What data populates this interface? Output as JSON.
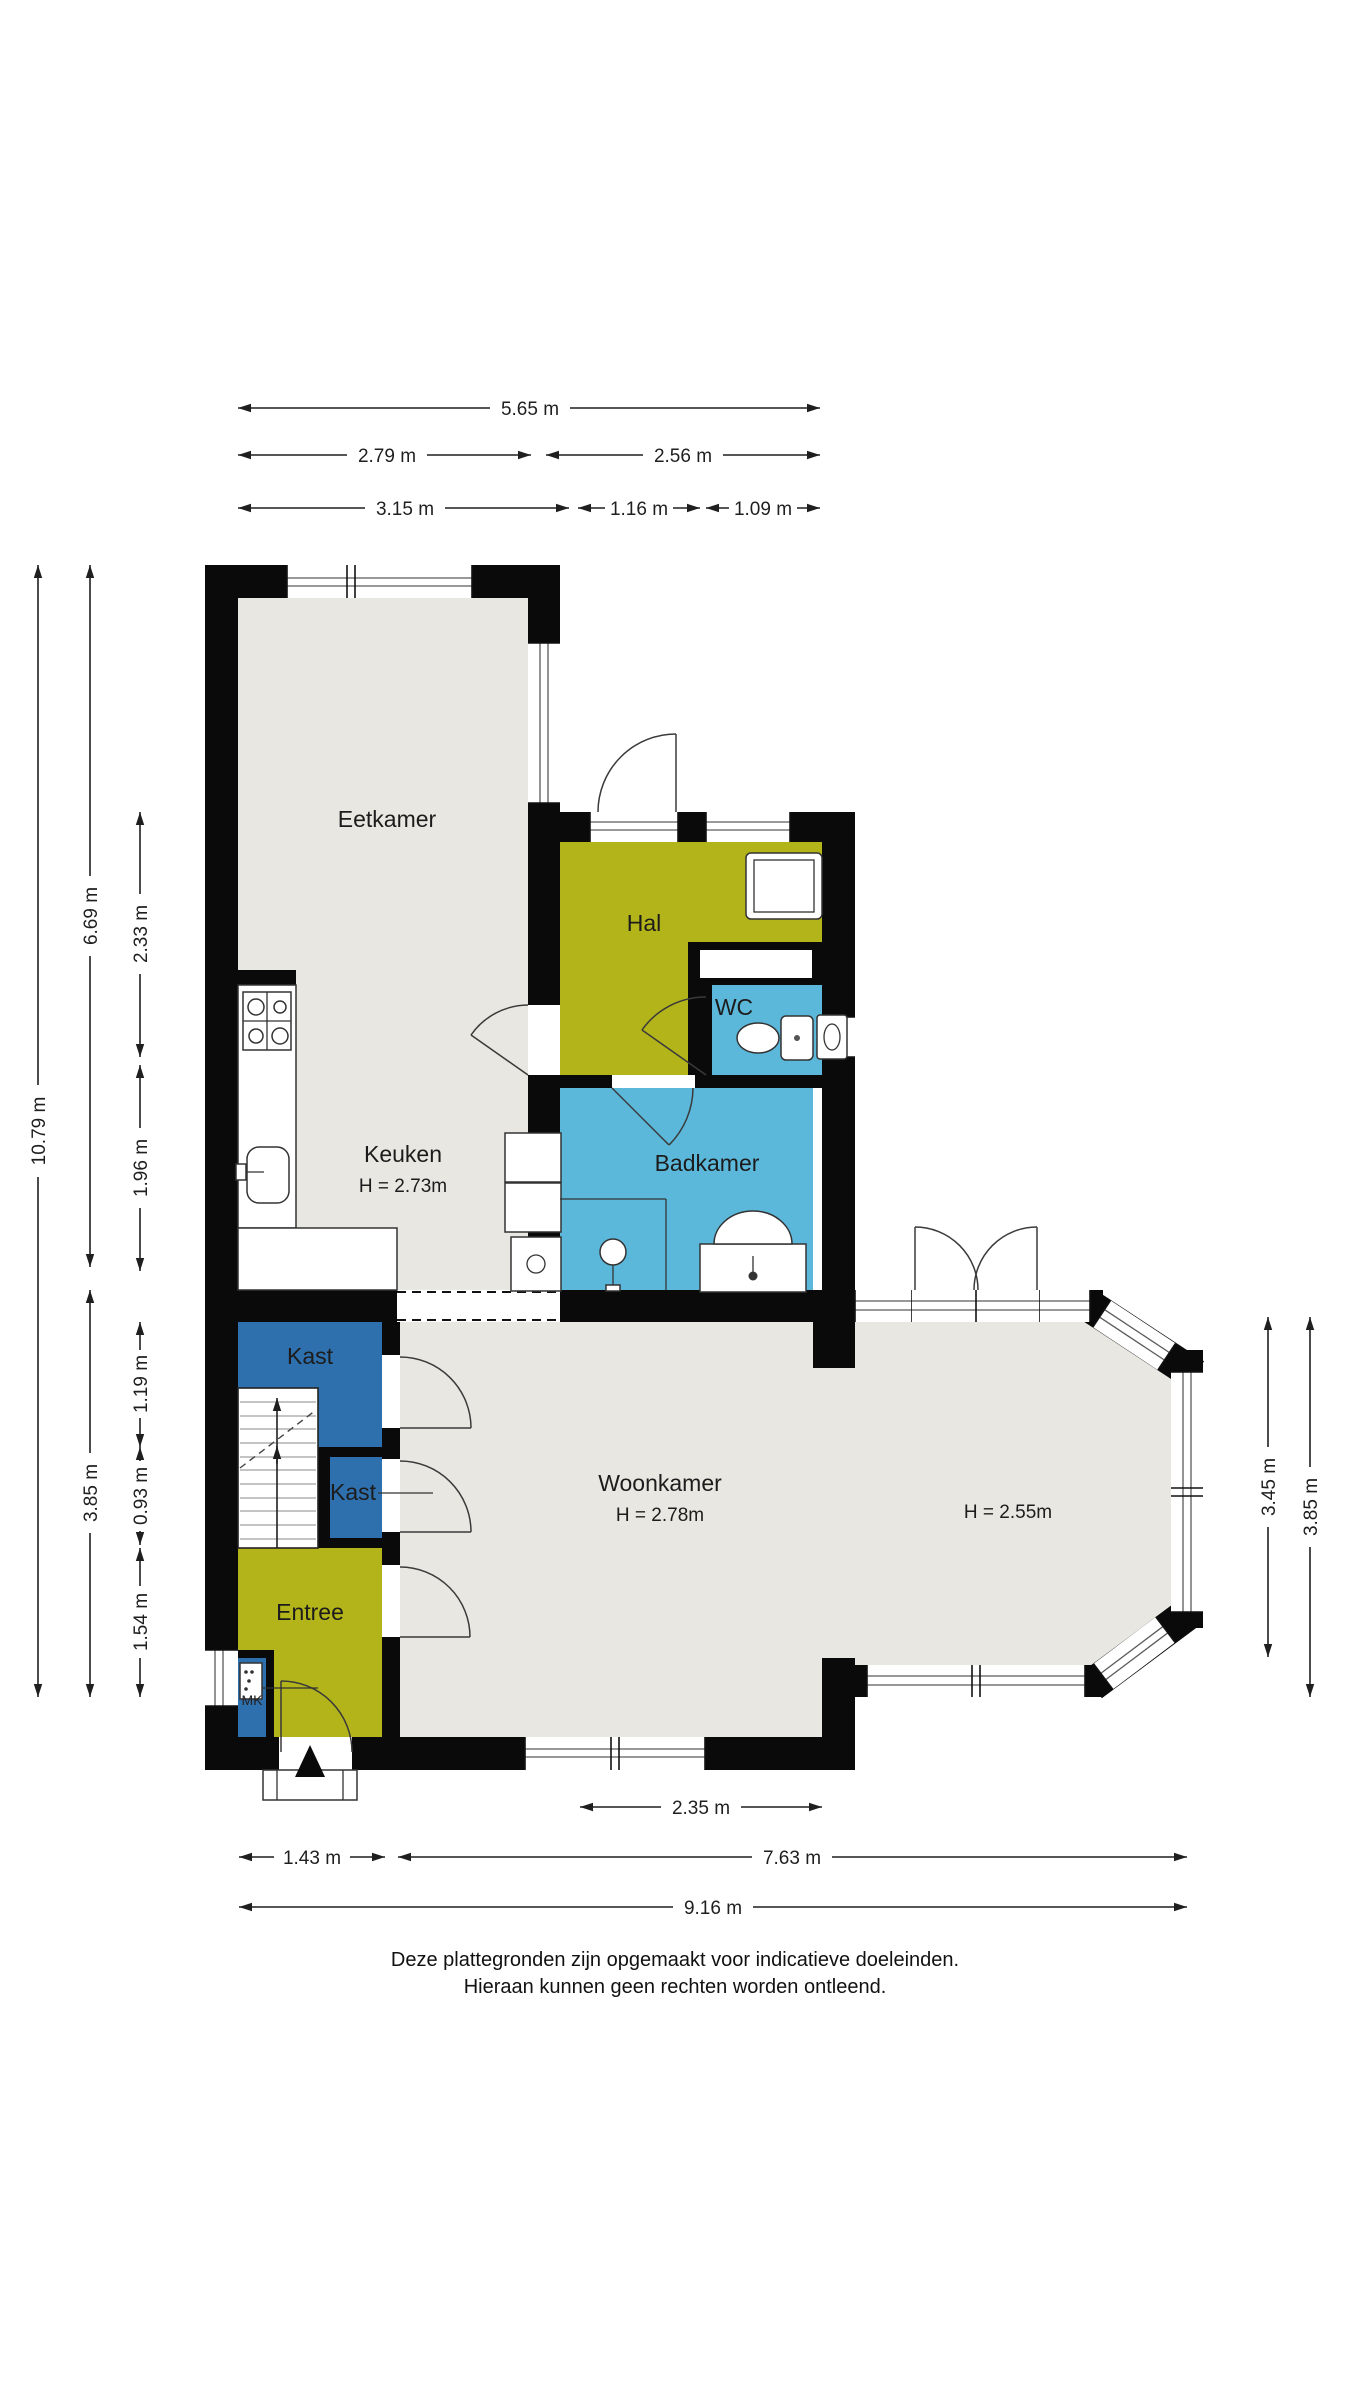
{
  "rooms": {
    "eetkamer": {
      "label": "Eetkamer"
    },
    "hal": {
      "label": "Hal"
    },
    "wc": {
      "label": "WC"
    },
    "keuken": {
      "label": "Keuken",
      "height": "H = 2.73m"
    },
    "badkamer": {
      "label": "Badkamer"
    },
    "kast_boven": {
      "label": "Kast"
    },
    "kast_onder": {
      "label": "Kast"
    },
    "entree": {
      "label": "Entree"
    },
    "meterkast": {
      "label": "MK"
    },
    "woonkamer": {
      "label": "Woonkamer",
      "height": "H = 2.78m",
      "height_erker": "H = 2.55m"
    }
  },
  "dims": {
    "top": {
      "total": "5.65 m",
      "row2_left": "2.79 m",
      "row2_right": "2.56 m",
      "row3_left": "3.15 m",
      "row3_mid": "1.16 m",
      "row3_right": "1.09 m"
    },
    "left": {
      "total": "10.79 m",
      "upper": "6.69 m",
      "lower": "3.85 m",
      "seg1": "2.33 m",
      "seg2": "1.96 m",
      "seg3": "1.19 m",
      "seg4": "0.93 m",
      "seg5": "1.54 m"
    },
    "right": {
      "inner": "3.45 m",
      "outer": "3.85 m"
    },
    "bottom": {
      "bay": "2.35 m",
      "left": "1.43 m",
      "right": "7.63 m",
      "total": "9.16 m"
    }
  },
  "footer": {
    "line1": "Deze plattegronden zijn opgemaakt voor indicatieve doeleinden.",
    "line2": "Hieraan kunnen geen rechten worden ontleend."
  },
  "icons": {
    "north_arrow": "north-arrow",
    "stairs_up": "stairs-up-arrow",
    "stove": "stove",
    "sink": "kitchen-sink",
    "toilet": "toilet",
    "shower": "shower-head",
    "bath_unit": "bath-vanity",
    "washer": "washing-machine"
  },
  "colors": {
    "floor": "#e8e7e1",
    "hall": "#b3b419",
    "wet": "#5cb8da",
    "closet": "#2e70ae",
    "wall": "#0a0a0a",
    "line": "#1f1f1f"
  }
}
